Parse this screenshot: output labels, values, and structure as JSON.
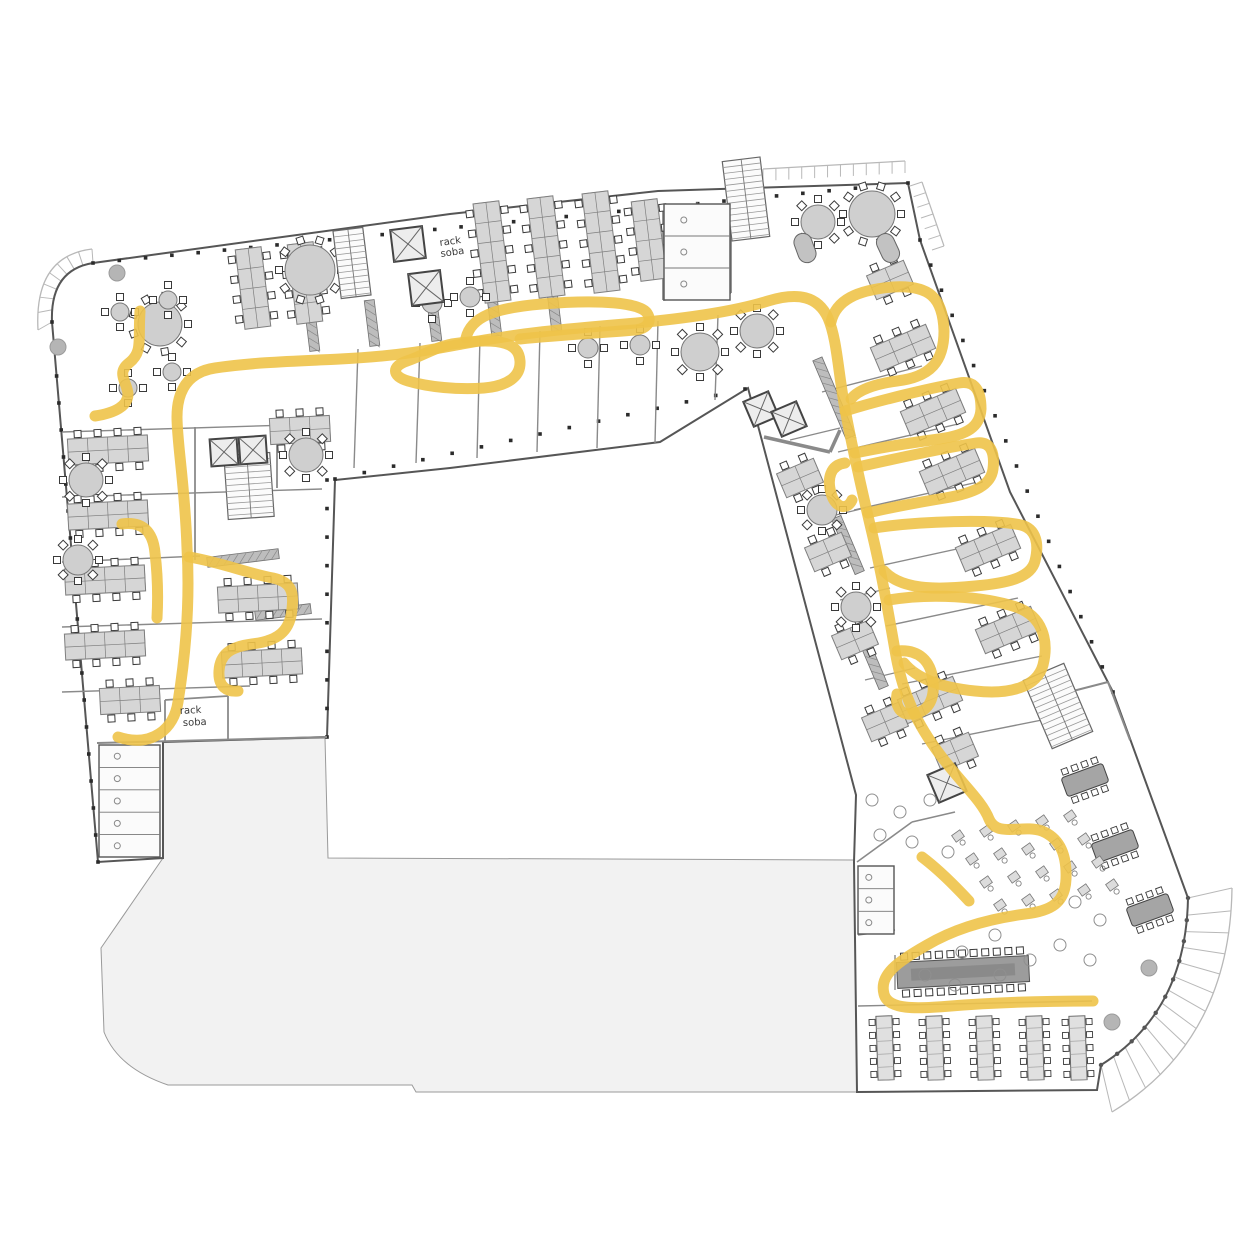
{
  "title": "office-floor-plan-with-route",
  "labels": {
    "rack_top_line1": "rack",
    "rack_top_line2": "soba",
    "rack_bottom_line1": "rack",
    "rack_bottom_line2": "soba"
  },
  "colors": {
    "route": "#eec349",
    "wall": "#565656",
    "wall_light": "#8a8a8a",
    "courtyard": "#f2f2f2",
    "courtyard_stroke": "#9a9a9a",
    "furniture_fill": "#d6d6d6",
    "furniture_stroke": "#7f7f7f",
    "terrace": "#b8b8b8",
    "chair": "#3a3a3a",
    "column": "#b5b5b5"
  },
  "route": {
    "width": 11,
    "opacity": 0.9,
    "paths": [
      {
        "name": "main-route",
        "d": "M118,737 C152,748 174,729 178,702 C186,652 190,600 187,548 C185,486 177,443 177,417 C177,392 187,372 215,368 C255,362 300,361 340,359 C400,356 430,350 462,344 C520,333 565,329 625,324 C683,319 733,312 768,301 C798,292 818,296 828,318 C837,339 838,371 845,409 C852,446 862,491 872,533 C882,575 889,616 896,656 C903,694 916,723 941,756 C963,785 982,801 989,819 C997,838 1022,824 1042,831 C1059,838 1067,853 1066,879 C1065,903 1051,911 1025,914 C995,918 959,926 927,945 C897,962 879,975 884,994 C888,1010 916,1009 951,1006 C1000,1002 1046,1001 1093,1001"
      },
      {
        "name": "hook-top-left",
        "d": "M140,311 C138,341 143,352 129,363 C116,373 127,382 128,394 C128,406 115,413 95,416"
      },
      {
        "name": "left-stub",
        "d": "M122,524 C142,521 153,531 155,553 C158,578 158,600 157,618"
      },
      {
        "name": "left-loop",
        "d": "M189,557 C220,562 250,574 273,578 C292,582 294,593 292,609 C290,632 277,641 252,644 C229,647 220,655 219,671 C218,687 227,692 238,691"
      },
      {
        "name": "top-wiggle-loop",
        "d": "M452,344 C505,336 519,345 520,361 C521,377 507,386 484,388 C458,390 428,387 408,381 C391,376 392,366 407,361 C422,356 436,347 452,344"
      },
      {
        "name": "top-upper-bubble",
        "d": "M466,338 C471,317 494,308 542,304 C602,299 640,303 647,313 C653,322 646,329 635,330 C598,333 560,335 520,339"
      },
      {
        "name": "right-loop-1",
        "d": "M831,322 C836,300 857,290 893,287 C929,285 943,297 944,331 C944,361 931,377 897,381 C875,384 858,390 851,399"
      },
      {
        "name": "right-loop-2",
        "d": "M845,411 C880,400 931,388 959,383 C976,380 981,392 981,409 C980,427 967,435 939,439 C909,443 874,449 855,453"
      },
      {
        "name": "right-loop-3",
        "d": "M858,467 C898,458 950,447 976,443 C991,441 995,453 993,469 C991,485 975,493 945,498 C915,503 884,509 868,513"
      },
      {
        "name": "right-loop-4",
        "d": "M874,528 C920,521 992,519 1021,525 C1037,529 1039,545 1035,561 C1031,577 1010,583 975,586 C945,589 903,592 884,571"
      },
      {
        "name": "right-loop-5",
        "d": "M889,600 C930,593 982,596 1016,607 C1043,616 1049,641 1043,665 C1037,687 1010,695 975,691 C945,688 918,680 904,663"
      },
      {
        "name": "right-lens",
        "d": "M897,651 C919,649 931,661 933,681 C935,701 927,713 911,714 C899,715 895,704 897,694"
      },
      {
        "name": "right-bulge",
        "d": "M845,463 C830,465 827,479 831,493 C835,508 847,511 852,500"
      },
      {
        "name": "cafe-stub",
        "d": "M922,857 C938,869 956,887 969,901"
      }
    ]
  },
  "building": {
    "outline": "M93,263 L450,214 L658,191 L908,183 L920,240 L1010,492 L1113,692 L1188,898 Q1186,1012 1101,1065 L1097,1090 L857,1092 L854,862 L856,795 L748,388 L660,442 L450,468 L335,480 L327,737 L163,742 L163,858 L98,862 L52,322 Q50,270 93,263 Z",
    "courtyard": "M163,742 L325,738 L328,858 L854,860 L857,1092 L416,1092 L412,1085 L168,1085 Q118,1068 104,1032 L101,948 L163,858 Z",
    "nw_band": {
      "inner": [
        [
          52,
          322
        ],
        [
          50,
          270
        ],
        [
          93,
          263
        ]
      ],
      "outer": [
        [
          38,
          330
        ],
        [
          34,
          256
        ],
        [
          92,
          249
        ]
      ],
      "ticks": 8
    },
    "se_fan": {
      "inner": [
        [
          1188,
          898
        ],
        [
          1186,
          1012
        ],
        [
          1101,
          1065
        ]
      ],
      "outer": [
        [
          1232,
          888
        ],
        [
          1230,
          1040
        ],
        [
          1112,
          1112
        ]
      ],
      "ticks": 13
    },
    "bands": [
      {
        "a": [
          763,
          181
        ],
        "b": [
          905,
          173
        ],
        "off": [
          0,
          -12
        ],
        "ticks": 11
      },
      {
        "a": [
          910,
          186
        ],
        "b": [
          932,
          250
        ],
        "off": [
          12,
          -4
        ],
        "ticks": 6
      }
    ],
    "facade_dot_lines": [
      {
        "a": [
          93,
          263
        ],
        "b": [
          908,
          183
        ],
        "step": 26
      },
      {
        "a": [
          52,
          322
        ],
        "b": [
          98,
          862
        ],
        "step": 26
      },
      {
        "a": [
          920,
          240
        ],
        "b": [
          1113,
          692
        ],
        "step": 26
      },
      {
        "a": [
          335,
          479
        ],
        "b": [
          745,
          389
        ],
        "step": 28
      },
      {
        "a": [
          327,
          480
        ],
        "b": [
          327,
          737
        ],
        "step": 26
      }
    ]
  },
  "walls": [
    [
      358,
      349,
      354,
      468,
      1.4
    ],
    [
      420,
      343,
      416,
      463,
      1.4
    ],
    [
      480,
      337,
      477,
      458,
      1.4
    ],
    [
      540,
      331,
      537,
      452,
      1.4
    ],
    [
      600,
      326,
      597,
      448,
      1.4
    ],
    [
      658,
      321,
      655,
      443,
      1.4
    ],
    [
      718,
      315,
      715,
      400,
      1.4
    ],
    [
      663,
      205,
      663,
      300,
      1.8
    ],
    [
      663,
      300,
      731,
      293,
      1.8
    ],
    [
      731,
      293,
      731,
      198,
      1.8
    ],
    [
      697,
      202,
      697,
      297,
      1
    ],
    [
      62,
      432,
      322,
      424,
      1.4
    ],
    [
      62,
      497,
      322,
      489,
      1.4
    ],
    [
      62,
      562,
      200,
      556,
      1.4
    ],
    [
      62,
      627,
      322,
      619,
      1.4
    ],
    [
      62,
      692,
      250,
      686,
      1.4
    ],
    [
      97,
      743,
      327,
      737,
      2
    ],
    [
      195,
      427,
      195,
      560,
      1.8
    ],
    [
      277,
      422,
      277,
      488,
      1.8
    ],
    [
      165,
      700,
      165,
      742,
      1.8
    ],
    [
      228,
      696,
      228,
      740,
      1.8
    ],
    [
      165,
      700,
      228,
      696,
      1.8
    ],
    [
      822,
      392,
      922,
      366,
      1.4
    ],
    [
      838,
      452,
      958,
      424,
      1.4
    ],
    [
      854,
      510,
      978,
      482,
      1.4
    ],
    [
      870,
      568,
      998,
      540,
      1.4
    ],
    [
      886,
      626,
      1018,
      598,
      1.4
    ],
    [
      902,
      684,
      1042,
      656,
      1.4
    ],
    [
      922,
      744,
      1062,
      716,
      1.4
    ],
    [
      790,
      440,
      840,
      428,
      1.2
    ],
    [
      815,
      520,
      865,
      508,
      1.2
    ],
    [
      840,
      600,
      890,
      588,
      1.2
    ],
    [
      865,
      680,
      915,
      668,
      1.2
    ],
    [
      857,
      862,
      912,
      822,
      1.6
    ],
    [
      912,
      822,
      955,
      812,
      1.6
    ],
    [
      1038,
      700,
      1108,
      682,
      2
    ],
    [
      1108,
      682,
      1130,
      740,
      2
    ],
    [
      858,
      1006,
      1092,
      1001,
      1.4
    ],
    [
      858,
      935,
      895,
      930,
      1.4
    ],
    [
      895,
      955,
      895,
      990,
      1.4
    ],
    [
      764,
      437,
      830,
      452,
      3.5
    ],
    [
      830,
      452,
      840,
      430,
      3.5
    ]
  ],
  "lockers": [
    [
      312,
      328,
      -7,
      46
    ],
    [
      372,
      323,
      -7,
      46
    ],
    [
      434,
      318,
      -7,
      46
    ],
    [
      494,
      313,
      -7,
      46
    ],
    [
      554,
      308,
      -7,
      46
    ],
    [
      243,
      558,
      83,
      72
    ],
    [
      283,
      612,
      83,
      56
    ],
    [
      834,
      398,
      -23,
      85
    ],
    [
      848,
      545,
      -23,
      60
    ],
    [
      872,
      660,
      -23,
      60
    ]
  ],
  "furniture": {
    "desk_banks": [
      [
        253,
        288,
        -7,
        4
      ],
      [
        305,
        283,
        -7,
        4
      ],
      [
        492,
        252,
        -7,
        5
      ],
      [
        546,
        247,
        -7,
        5
      ],
      [
        601,
        242,
        -7,
        5
      ],
      [
        649,
        240,
        -7,
        4
      ],
      [
        108,
        450,
        87,
        4
      ],
      [
        108,
        515,
        87,
        4
      ],
      [
        105,
        580,
        87,
        4
      ],
      [
        105,
        645,
        87,
        4
      ],
      [
        258,
        598,
        87,
        4
      ],
      [
        262,
        663,
        87,
        4
      ],
      [
        130,
        700,
        87,
        3
      ],
      [
        300,
        430,
        87,
        3
      ],
      [
        903,
        348,
        67,
        3
      ],
      [
        933,
        412,
        67,
        3
      ],
      [
        952,
        472,
        67,
        3
      ],
      [
        988,
        548,
        67,
        3
      ],
      [
        1008,
        630,
        67,
        3
      ],
      [
        930,
        700,
        67,
        3
      ],
      [
        955,
        752,
        67,
        2
      ],
      [
        800,
        478,
        67,
        2
      ],
      [
        828,
        552,
        67,
        2
      ],
      [
        855,
        640,
        67,
        2
      ],
      [
        885,
        722,
        67,
        2
      ],
      [
        890,
        280,
        67,
        2
      ]
    ],
    "round_tables": [
      [
        160,
        324,
        22,
        9
      ],
      [
        310,
        270,
        25,
        10
      ],
      [
        818,
        222,
        17,
        8
      ],
      [
        872,
        214,
        23,
        10
      ],
      [
        86,
        480,
        17,
        8
      ],
      [
        78,
        560,
        15,
        8
      ],
      [
        700,
        352,
        19,
        8
      ],
      [
        757,
        331,
        17,
        8
      ],
      [
        822,
        510,
        15,
        8
      ],
      [
        856,
        607,
        15,
        8
      ],
      [
        306,
        455,
        17,
        8
      ],
      [
        120,
        312,
        9,
        4
      ],
      [
        168,
        300,
        9,
        4
      ],
      [
        128,
        388,
        9,
        4
      ],
      [
        172,
        372,
        9,
        4
      ],
      [
        588,
        348,
        10,
        4
      ],
      [
        640,
        345,
        10,
        4
      ],
      [
        432,
        303,
        10,
        4
      ],
      [
        470,
        297,
        10,
        4
      ]
    ],
    "stairs": [
      [
        352,
        263,
        30,
        68,
        -7
      ],
      [
        746,
        199,
        38,
        80,
        -7
      ],
      [
        249,
        486,
        46,
        64,
        -4
      ],
      [
        1058,
        706,
        44,
        74,
        -23
      ]
    ],
    "elevators": [
      [
        408,
        244,
        32,
        -7
      ],
      [
        426,
        288,
        32,
        -7
      ],
      [
        224,
        452,
        27,
        -4
      ],
      [
        253,
        450,
        27,
        -4
      ],
      [
        761,
        409,
        27,
        -23
      ],
      [
        789,
        419,
        27,
        -23
      ],
      [
        947,
        783,
        30,
        -23
      ]
    ],
    "wash_strips": [
      {
        "x": 99,
        "y": 745,
        "w": 61,
        "h": 112,
        "cells": 5
      },
      {
        "x": 664,
        "y": 204,
        "w": 66,
        "h": 96,
        "cells": 3
      },
      {
        "x": 858,
        "y": 866,
        "w": 36,
        "h": 68,
        "cells": 3
      }
    ],
    "cafeteria_tables": [
      [
        885,
        1048
      ],
      [
        935,
        1048
      ],
      [
        985,
        1048
      ],
      [
        1035,
        1048
      ],
      [
        1078,
        1048
      ]
    ],
    "conference_table": {
      "x": 963,
      "y": 972,
      "w": 132,
      "h": 26,
      "rot": -3,
      "chairs": 11
    },
    "boardrooms": [
      [
        1085,
        780
      ],
      [
        1115,
        846
      ],
      [
        1150,
        910
      ]
    ],
    "fan_rows": {
      "rows": 4,
      "cols": 5,
      "x0": 958,
      "y0": 836,
      "dxc": 28,
      "dyc": -5,
      "dxr": 14,
      "dyr": 23,
      "rot": -35
    },
    "pods": [
      [
        805,
        248,
        -20
      ],
      [
        888,
        248,
        -25
      ]
    ],
    "dots": [
      [
        872,
        800
      ],
      [
        900,
        812
      ],
      [
        930,
        800
      ],
      [
        880,
        835
      ],
      [
        912,
        842
      ],
      [
        948,
        852
      ],
      [
        1075,
        902
      ],
      [
        1100,
        920
      ],
      [
        925,
        975
      ],
      [
        955,
        985
      ],
      [
        1000,
        975
      ],
      [
        1030,
        960
      ],
      [
        1060,
        945
      ],
      [
        995,
        935
      ],
      [
        962,
        952
      ],
      [
        1090,
        960
      ]
    ],
    "columns": [
      [
        117,
        273
      ],
      [
        58,
        347
      ],
      [
        1149,
        968
      ],
      [
        1112,
        1022
      ]
    ]
  }
}
